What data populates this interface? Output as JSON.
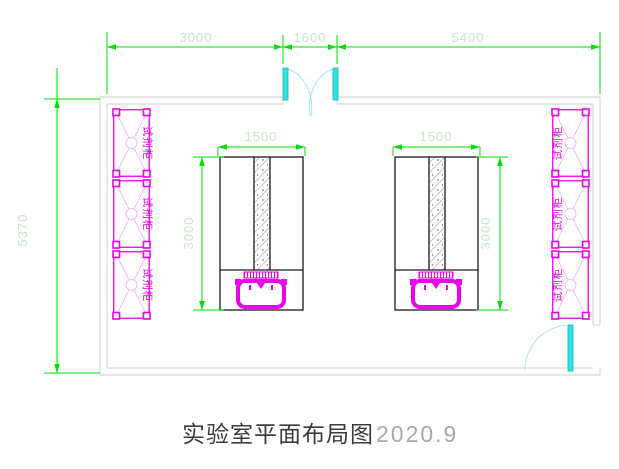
{
  "title": {
    "text_cn": "实验室平面布局图",
    "text_year": "2020.9"
  },
  "dimensions": {
    "top_row": [
      {
        "label": "3000"
      },
      {
        "label": "1600"
      },
      {
        "label": "5400"
      }
    ],
    "left_wall": {
      "label": "5370"
    },
    "bench_left": {
      "width": "1500",
      "depth": "3000"
    },
    "bench_right": {
      "width": "1500",
      "depth": "3000"
    }
  },
  "cabinets": {
    "label": "试剂柜",
    "left_wall_count": 3,
    "right_wall_count": 3
  },
  "colors": {
    "dimension_line": "#00dd00",
    "dimension_text": "#bfecbf",
    "cabinet": "#ee00ee",
    "cabinet_detail": "#f2a8f2",
    "door": "#2fe3e3",
    "wall": "#cfcfcf",
    "bench_outline": "#1a1a1a",
    "title_text": "#3c3c3c"
  }
}
